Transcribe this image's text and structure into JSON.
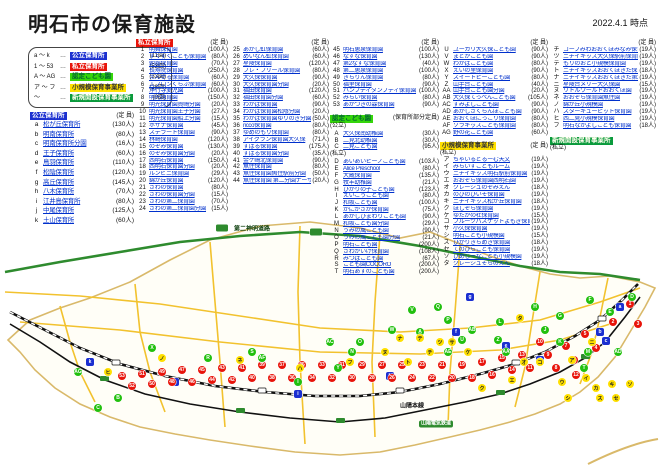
{
  "title": "明石市の保育施設",
  "date": "2022.4.1 時点",
  "legend": {
    "items": [
      {
        "range": "a ～ k",
        "label": "公立保育所",
        "count": "(11園)",
        "type": "pub"
      },
      {
        "range": "1 ～ 53",
        "label": "私立保育所",
        "count": "(53園)",
        "type": "pri"
      },
      {
        "range": "A ～ AG",
        "label": "認定こども園",
        "count": "(33園)",
        "type": "nin"
      },
      {
        "range": "ア ～ フ",
        "label": "小規模保育事業所",
        "count": "(28園)",
        "type": "sho"
      },
      {
        "range": "～",
        "label": "新規開設保育事業所",
        "count": "(0園)",
        "type": "new"
      }
    ]
  },
  "sections": {
    "pub": {
      "header": "公立保育所",
      "cap_header": "(定 員)",
      "items": [
        [
          "a",
          "松が丘保育所",
          130
        ],
        [
          "b",
          "明南保育所",
          80
        ],
        [
          "c",
          "明南保育所分園",
          16
        ],
        [
          "d",
          "王子保育所",
          60
        ],
        [
          "e",
          "鳥羽保育所",
          110
        ],
        [
          "f",
          "松陰保育所",
          120
        ],
        [
          "g",
          "高丘保育所",
          145
        ],
        [
          "h",
          "八木保育所",
          70
        ],
        [
          "i",
          "江井島保育所",
          80
        ],
        [
          "j",
          "中尾保育所",
          125
        ],
        [
          "k",
          "土山保育所",
          60
        ]
      ]
    },
    "pri": {
      "header": "私立保育所",
      "cap_header": "(定 員)",
      "col1": [
        [
          "1",
          "明舞保育園",
          100
        ],
        [
          "2",
          "すくすくこども保育園",
          80
        ],
        [
          "3",
          "朝霧保育園",
          70
        ],
        [
          "4",
          "長寿院保育園",
          250
        ],
        [
          "5",
          "えんぜる保育園",
          60
        ],
        [
          "6",
          "エプロンくらぶ保育園",
          60
        ],
        [
          "7",
          "浄行寺愛児園",
          100
        ],
        [
          "8",
          "明光保育園",
          150
        ],
        [
          "9",
          "明光保育園貴崎分園",
          20
        ],
        [
          "10",
          "明光保育園王子分園",
          27
        ],
        [
          "11",
          "明光保育園船上分園",
          15
        ],
        [
          "12",
          "ホザナ保育園",
          45
        ],
        [
          "13",
          "ステラート保育園",
          90
        ],
        [
          "14",
          "林崎保育園",
          120
        ],
        [
          "15",
          "のぞみ保育園",
          130
        ],
        [
          "16",
          "のぞみ保育園分園",
          20
        ],
        [
          "17",
          "西明石保育園",
          150
        ],
        [
          "18",
          "西明石保育園分園",
          20
        ],
        [
          "19",
          "ルンビニ保育園",
          29
        ],
        [
          "20",
          "錦が丘保育園",
          120
        ],
        [
          "21",
          "さわの保育園",
          80
        ],
        [
          "22",
          "さわの保育園分園",
          15
        ],
        [
          "23",
          "さわの第二保育園",
          70
        ],
        [
          "24",
          "さわの第二保育園分園",
          15
        ]
      ],
      "col2": [
        [
          "25",
          "あかし虹保育園",
          60
        ],
        [
          "26",
          "めいなん虹保育園",
          60
        ],
        [
          "27",
          "星陵保育園",
          120
        ],
        [
          "28",
          "フレ・フリール保育園",
          80
        ],
        [
          "29",
          "大久保保育園",
          90
        ],
        [
          "30",
          "大久保保育園分園",
          20
        ],
        [
          "31",
          "福田保育園",
          120
        ],
        [
          "32",
          "福田保育園分園",
          60
        ],
        [
          "33",
          "わかば保育園",
          90
        ],
        [
          "34",
          "わかば保育園松陰分園",
          20
        ],
        [
          "35",
          "わかば保育園ゆりのき分園",
          50
        ],
        [
          "36",
          "ricco保育園",
          80
        ],
        [
          "37",
          "ゆめのもり保育園",
          80
        ],
        [
          "38",
          "アイグラン保育園大久保",
          71
        ],
        [
          "39",
          "すばる保育園",
          175
        ],
        [
          "40",
          "すばる保育園分園",
          35
        ],
        [
          "41",
          "金ケ崎北保育園",
          90
        ],
        [
          "42",
          "魚住保育園",
          80
        ],
        [
          "43",
          "魚住保育園魚住駅前分園",
          50
        ],
        [
          "44",
          "魚住保育園 第二分園ナーサリー",
          20
        ]
      ],
      "col3": [
        [
          "45",
          "明石恵泉保育園",
          100
        ],
        [
          "46",
          "なずな保育園",
          130
        ],
        [
          "47",
          "第2なずな保育園",
          40
        ],
        [
          "48",
          "第二恵泉保育園",
          100
        ],
        [
          "49",
          "きらりん保育園",
          80
        ],
        [
          "50",
          "福里保育園",
          90
        ],
        [
          "51",
          "ハンプティダンプティ保育園",
          100
        ],
        [
          "52",
          "みらい保育園",
          80
        ],
        [
          "53",
          "あかつきの森保育園",
          90
        ]
      ]
    },
    "nin": {
      "header": "認定こども園",
      "note": "(保育所部分定員)",
      "pub_label": "(公立)",
      "pri_label": "(私立)",
      "pub_items": [
        [
          "A",
          "大久保南幼稚園",
          30
        ],
        [
          "B",
          "二見北幼稚園",
          30
        ],
        [
          "C",
          "二見こども園",
          95
        ]
      ],
      "pri_items1": [
        [
          "D",
          "あいあいピーノこども園",
          103
        ],
        [
          "E",
          "Alice Preschool",
          80
        ],
        [
          "F",
          "大蔵保育園",
          135
        ],
        [
          "G",
          "牧羊幼稚園",
          21
        ],
        [
          "H",
          "ひかりの子こども園",
          123
        ],
        [
          "I",
          "えいこうこども園",
          80
        ],
        [
          "J",
          "和坂こども園",
          100
        ],
        [
          "K",
          "かにがさか保育園",
          75
        ],
        [
          "L",
          "あかしひまわりこども園",
          90
        ],
        [
          "M",
          "和坂こども園分園",
          29
        ],
        [
          "N",
          "うみの風こども園",
          90
        ],
        [
          "O",
          "うみの風こども園分園",
          21
        ],
        [
          "P",
          "明石こども園",
          200
        ],
        [
          "Q",
          "さわがいけ保育園",
          108
        ],
        [
          "R",
          "みつばこども園",
          67
        ],
        [
          "S",
          "こども園COCORO",
          200
        ],
        [
          "T",
          "明石あすのこども園",
          200
        ]
      ],
      "pri_items2": [
        [
          "U",
          "ユーカリ大久保こども園",
          90
        ],
        [
          "V",
          "まどかこども園",
          90
        ],
        [
          "W",
          "わかばこども園",
          80
        ],
        [
          "X",
          "えいの里保育園",
          90
        ],
        [
          "Y",
          "スイートピーこども園",
          80
        ],
        [
          "Z",
          "山手台こども園",
          40
        ],
        [
          "AA",
          "山手台こども園分園",
          20
        ],
        [
          "AB",
          "大久保てっぺんこども園",
          105
        ],
        [
          "AC",
          "すみよしこども園",
          90
        ],
        [
          "AD",
          "あかしさくらんぼこども園",
          90
        ],
        [
          "AE",
          "おおくぼにっこり保育園",
          80
        ],
        [
          "AF",
          "ソラキッズこども保育園",
          80
        ],
        [
          "AG",
          "野の花こども園",
          60
        ]
      ]
    },
    "sho": {
      "header": "小規模保育事業所",
      "cap_header": "(定 員)",
      "pri_label": "(私立)",
      "items1": [
        [
          "ア",
          "ちゃいるどるーむ天文",
          19
        ],
        [
          "イ",
          "みらいずこどもルーム",
          19
        ],
        [
          "ウ",
          "ニチイキッズ明石駅前保育園",
          19
        ],
        [
          "エ",
          "おおぞら保育園西明石園",
          19
        ],
        [
          "オ",
          "クレーシュのぞみえん",
          18
        ],
        [
          "カ",
          "のびのびいそ保育園",
          19
        ],
        [
          "キ",
          "ニチイキッズ松が丘保育園",
          18
        ],
        [
          "ク",
          "ほしぞら保育園",
          19
        ],
        [
          "ケ",
          "ゆたかの杜保育園",
          15
        ],
        [
          "コ",
          "フルーツバスケットよもぎ保育園",
          19
        ],
        [
          "サ",
          "小久保保育園",
          19
        ],
        [
          "シ",
          "明石こども小規模園",
          15
        ],
        [
          "ス",
          "ひかりきらめき保育園",
          18
        ],
        [
          "セ",
          "てのひらこども保育園",
          19
        ],
        [
          "ソ",
          "ひめじーなこども小規模園",
          19
        ],
        [
          "タ",
          "クレーシュそらのえん",
          18
        ]
      ],
      "items2": [
        [
          "チ",
          "コープみわおおくぼみなみ保育園",
          19
        ],
        [
          "ツ",
          "ニチイキッズ大久保駅前保育園",
          19
        ],
        [
          "テ",
          "もりのおと小規模保育園",
          19
        ],
        [
          "ト",
          "ニチイキッズおおくぼきた保育園",
          18
        ],
        [
          "ナ",
          "ニチイキッズおおくぼきた第2保育園",
          19
        ],
        [
          "ニ",
          "星陵台メリー大久保園",
          15
        ],
        [
          "ヌ",
          "リトルワールドおおくぼ園",
          19
        ],
        [
          "ネ",
          "おおぞら保育園魚住園",
          19
        ],
        [
          "ノ",
          "錦が丘小規模園",
          19
        ],
        [
          "ハ",
          "スターキューピット保育園",
          19
        ],
        [
          "ヒ",
          "西二見小規模保育園",
          19
        ],
        [
          "フ",
          "明石なかよしこども保育園",
          18
        ]
      ]
    },
    "newsec": {
      "header": "新規開設保育事業所",
      "pri_label": "(私立)"
    }
  },
  "map": {
    "labels": [
      {
        "text": "第二神明道路",
        "x": 252,
        "y": 16,
        "cls": "road"
      },
      {
        "text": "山陽本線",
        "x": 412,
        "y": 193,
        "cls": "rail"
      },
      {
        "text": "山陽電気鉄道",
        "x": 436,
        "y": 212,
        "cls": "railbox"
      }
    ],
    "markers": [
      [
        "pub",
        "a",
        620,
        95
      ],
      [
        "pub",
        "b",
        600,
        120
      ],
      [
        "pub",
        "c",
        606,
        129
      ],
      [
        "pub",
        "d",
        540,
        148
      ],
      [
        "pub",
        "e",
        506,
        134
      ],
      [
        "pub",
        "f",
        456,
        120
      ],
      [
        "pub",
        "g",
        470,
        85
      ],
      [
        "pub",
        "h",
        390,
        164
      ],
      [
        "pub",
        "i",
        298,
        182
      ],
      [
        "pub",
        "j",
        175,
        170
      ],
      [
        "pub",
        "k",
        90,
        150
      ],
      [
        "pri",
        "1",
        630,
        92
      ],
      [
        "pri",
        "2",
        613,
        110
      ],
      [
        "pri",
        "3",
        638,
        112
      ],
      [
        "pri",
        "4",
        596,
        136
      ],
      [
        "pri",
        "5",
        585,
        122
      ],
      [
        "pri",
        "6",
        574,
        148
      ],
      [
        "pri",
        "7",
        566,
        134
      ],
      [
        "pri",
        "8",
        556,
        156
      ],
      [
        "pri",
        "9",
        548,
        143
      ],
      [
        "pri",
        "10",
        540,
        130
      ],
      [
        "pri",
        "11",
        530,
        156
      ],
      [
        "pri",
        "12",
        576,
        163
      ],
      [
        "pri",
        "13",
        522,
        143
      ],
      [
        "pri",
        "14",
        512,
        158
      ],
      [
        "pri",
        "15",
        502,
        146
      ],
      [
        "pri",
        "16",
        492,
        163
      ],
      [
        "pri",
        "17",
        482,
        150
      ],
      [
        "pri",
        "18",
        472,
        166
      ],
      [
        "pri",
        "19",
        462,
        153
      ],
      [
        "pri",
        "20",
        452,
        166
      ],
      [
        "pri",
        "21",
        442,
        153
      ],
      [
        "pri",
        "22",
        432,
        166
      ],
      [
        "pri",
        "23",
        422,
        153
      ],
      [
        "pri",
        "24",
        412,
        166
      ],
      [
        "pri",
        "25",
        402,
        153
      ],
      [
        "pri",
        "26",
        392,
        166
      ],
      [
        "pri",
        "27",
        382,
        153
      ],
      [
        "pri",
        "28",
        372,
        166
      ],
      [
        "pri",
        "29",
        362,
        153
      ],
      [
        "pri",
        "30",
        352,
        166
      ],
      [
        "pri",
        "31",
        342,
        153
      ],
      [
        "pri",
        "32",
        332,
        166
      ],
      [
        "pri",
        "33",
        322,
        153
      ],
      [
        "pri",
        "34",
        312,
        166
      ],
      [
        "pri",
        "35",
        302,
        153
      ],
      [
        "pri",
        "36",
        292,
        166
      ],
      [
        "pri",
        "37",
        282,
        153
      ],
      [
        "pri",
        "38",
        272,
        166
      ],
      [
        "pri",
        "39",
        262,
        153
      ],
      [
        "pri",
        "40",
        252,
        166
      ],
      [
        "pri",
        "41",
        242,
        156
      ],
      [
        "pri",
        "42",
        232,
        168
      ],
      [
        "pri",
        "43",
        222,
        156
      ],
      [
        "pri",
        "44",
        212,
        168
      ],
      [
        "pri",
        "45",
        202,
        158
      ],
      [
        "pri",
        "46",
        192,
        170
      ],
      [
        "pri",
        "47",
        182,
        158
      ],
      [
        "pri",
        "48",
        172,
        170
      ],
      [
        "pri",
        "49",
        162,
        160
      ],
      [
        "pri",
        "50",
        152,
        172
      ],
      [
        "pri",
        "51",
        142,
        162
      ],
      [
        "pri",
        "52",
        132,
        174
      ],
      [
        "pri",
        "53",
        122,
        164
      ],
      [
        "nin",
        "A",
        420,
        120
      ],
      [
        "nin",
        "B",
        118,
        186
      ],
      [
        "nin",
        "C",
        98,
        196
      ],
      [
        "nin",
        "D",
        632,
        85
      ],
      [
        "nin",
        "E",
        610,
        100
      ],
      [
        "nin",
        "F",
        590,
        88
      ],
      [
        "nin",
        "G",
        560,
        104
      ],
      [
        "nin",
        "H",
        535,
        95
      ],
      [
        "nin",
        "I",
        298,
        170
      ],
      [
        "nin",
        "J",
        545,
        118
      ],
      [
        "nin",
        "K",
        560,
        130
      ],
      [
        "nin",
        "L",
        500,
        110
      ],
      [
        "nin",
        "M",
        588,
        140
      ],
      [
        "nin",
        "N",
        352,
        140
      ],
      [
        "nin",
        "O",
        360,
        130
      ],
      [
        "nin",
        "P",
        448,
        108
      ],
      [
        "nin",
        "Q",
        438,
        95
      ],
      [
        "nin",
        "R",
        208,
        146
      ],
      [
        "nin",
        "S",
        252,
        140
      ],
      [
        "nin",
        "T",
        584,
        156
      ],
      [
        "nin",
        "U",
        462,
        128
      ],
      [
        "nin",
        "V",
        412,
        98
      ],
      [
        "nin",
        "W",
        392,
        118
      ],
      [
        "nin",
        "X",
        152,
        136
      ],
      [
        "nin",
        "Y",
        338,
        156
      ],
      [
        "nin",
        "Z",
        498,
        128
      ],
      [
        "nin",
        "AA",
        506,
        140
      ],
      [
        "nin",
        "AB",
        472,
        118
      ],
      [
        "nin",
        "AC",
        330,
        130
      ],
      [
        "nin",
        "AD",
        618,
        140
      ],
      [
        "nin",
        "AE",
        448,
        140
      ],
      [
        "nin",
        "AF",
        262,
        146
      ],
      [
        "nin",
        "AG",
        78,
        160
      ],
      [
        "sho",
        "ア",
        572,
        148
      ],
      [
        "sho",
        "イ",
        586,
        166
      ],
      [
        "sho",
        "ウ",
        562,
        170
      ],
      [
        "sho",
        "エ",
        512,
        168
      ],
      [
        "sho",
        "オ",
        524,
        150
      ],
      [
        "sho",
        "カ",
        596,
        176
      ],
      [
        "sho",
        "キ",
        612,
        172
      ],
      [
        "sho",
        "ク",
        482,
        176
      ],
      [
        "sho",
        "ケ",
        468,
        140
      ],
      [
        "sho",
        "コ",
        540,
        150
      ],
      [
        "sho",
        "サ",
        452,
        130
      ],
      [
        "sho",
        "シ",
        568,
        186
      ],
      [
        "sho",
        "ス",
        600,
        186
      ],
      [
        "sho",
        "セ",
        616,
        186
      ],
      [
        "sho",
        "ソ",
        630,
        172
      ],
      [
        "sho",
        "タ",
        520,
        106
      ],
      [
        "sho",
        "チ",
        430,
        140
      ],
      [
        "sho",
        "ツ",
        440,
        130
      ],
      [
        "sho",
        "テ",
        420,
        126
      ],
      [
        "sho",
        "ト",
        408,
        150
      ],
      [
        "sho",
        "ナ",
        400,
        126
      ],
      [
        "sho",
        "ニ",
        592,
        130
      ],
      [
        "sho",
        "ヌ",
        385,
        140
      ],
      [
        "sho",
        "ネ",
        240,
        148
      ],
      [
        "sho",
        "ノ",
        162,
        146
      ],
      [
        "sho",
        "ハ",
        300,
        156
      ],
      [
        "sho",
        "ヒ",
        108,
        160
      ],
      [
        "sho",
        "フ",
        350,
        150
      ]
    ]
  }
}
